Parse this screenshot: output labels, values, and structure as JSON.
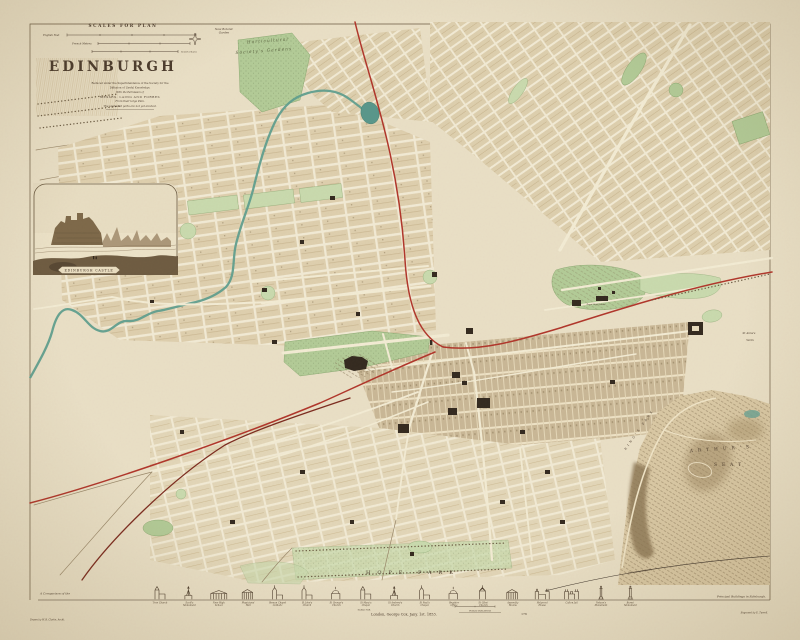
{
  "colors": {
    "paper": "#e9dfc6",
    "ink": "#4a3a2c",
    "park_green": "#b2cb97",
    "pale_green": "#c9daae",
    "water_teal": "#5f9e8e",
    "railway_red": "#b0352a",
    "railway_dark_red": "#7c2b1f",
    "building_dark": "#33291f",
    "hill_shade": "#8a7452"
  },
  "title_block": {
    "scales_heading": "SCALES FOR PLAN",
    "scale_bars": [
      {
        "label": "English Feet"
      },
      {
        "label": "French Metres"
      },
      {
        "label": "Scotch Chains"
      }
    ],
    "title": "EDINBURGH",
    "attribution_lines": [
      "Reduced under the Superintendence of the Society for the",
      "Diffusion of Useful Knowledge.",
      "With the Permission of",
      "MESSRS. LAING AND FORBES",
      "From their large Plan.",
      "The unshaded parts are not yet erected."
    ]
  },
  "vignette": {
    "caption": "EDINBURGH CASTLE"
  },
  "map_labels": {
    "new_botanic_1": "New Botanic",
    "new_botanic_2": "Garden",
    "horticultural_1": "Horticultural",
    "horticultural_2": "Society's Gardens",
    "royal_high_school": "Royal High School",
    "st_annes_1": "St Anne's",
    "st_annes_2": "Yards",
    "hope_park": "HOPE PARK",
    "arthurs_seat_1": "ARTHUR'S",
    "arthurs_seat_2": "SEAT",
    "kings_park": "KING'S PARK",
    "railway_dalkeith": "Railway to Dalkeith"
  },
  "footer": {
    "comparison_prefix": "A Comparison of the",
    "principal_buildings": "Principal Buildings in Edinburgh.",
    "scale_for": "SCALE FOR",
    "public_buildings": "PUBLIC BUILDINGS",
    "imprint": "London, George Cox, Jany. 1st. 1853.",
    "plate_number": "176",
    "drawn_by": "Drawn by W. B. Clarke, Archt.",
    "engraved_by": "Engraved by E. Turrell.",
    "buildings": [
      {
        "name": "Tron Church",
        "glyph": "tower"
      },
      {
        "name": "Scott's Monument",
        "glyph": "spire"
      },
      {
        "name": "New High School",
        "glyph": "colonnade"
      },
      {
        "name": "Physicians' Hall",
        "glyph": "portico"
      },
      {
        "name": "Roman Catholic Chapel",
        "glyph": "gothic"
      },
      {
        "name": "St John's Church",
        "glyph": "gothic"
      },
      {
        "name": "St George's Church",
        "glyph": "dome"
      },
      {
        "name": "St Mary's Chapel",
        "glyph": "tower"
      },
      {
        "name": "St Andrew's Church",
        "glyph": "spire"
      },
      {
        "name": "St Paul's Chapel",
        "glyph": "gothic"
      },
      {
        "name": "Register Office",
        "glyph": "dome"
      },
      {
        "name": "St Giles' Church",
        "glyph": "crown"
      },
      {
        "name": "Assembly Rooms",
        "glyph": "portico"
      },
      {
        "name": "Holyrood House",
        "glyph": "palace"
      },
      {
        "name": "Calton Jail",
        "glyph": "castle"
      },
      {
        "name": "Nelson's Monument",
        "glyph": "column"
      },
      {
        "name": "Burns' Monument",
        "glyph": "column"
      }
    ]
  }
}
